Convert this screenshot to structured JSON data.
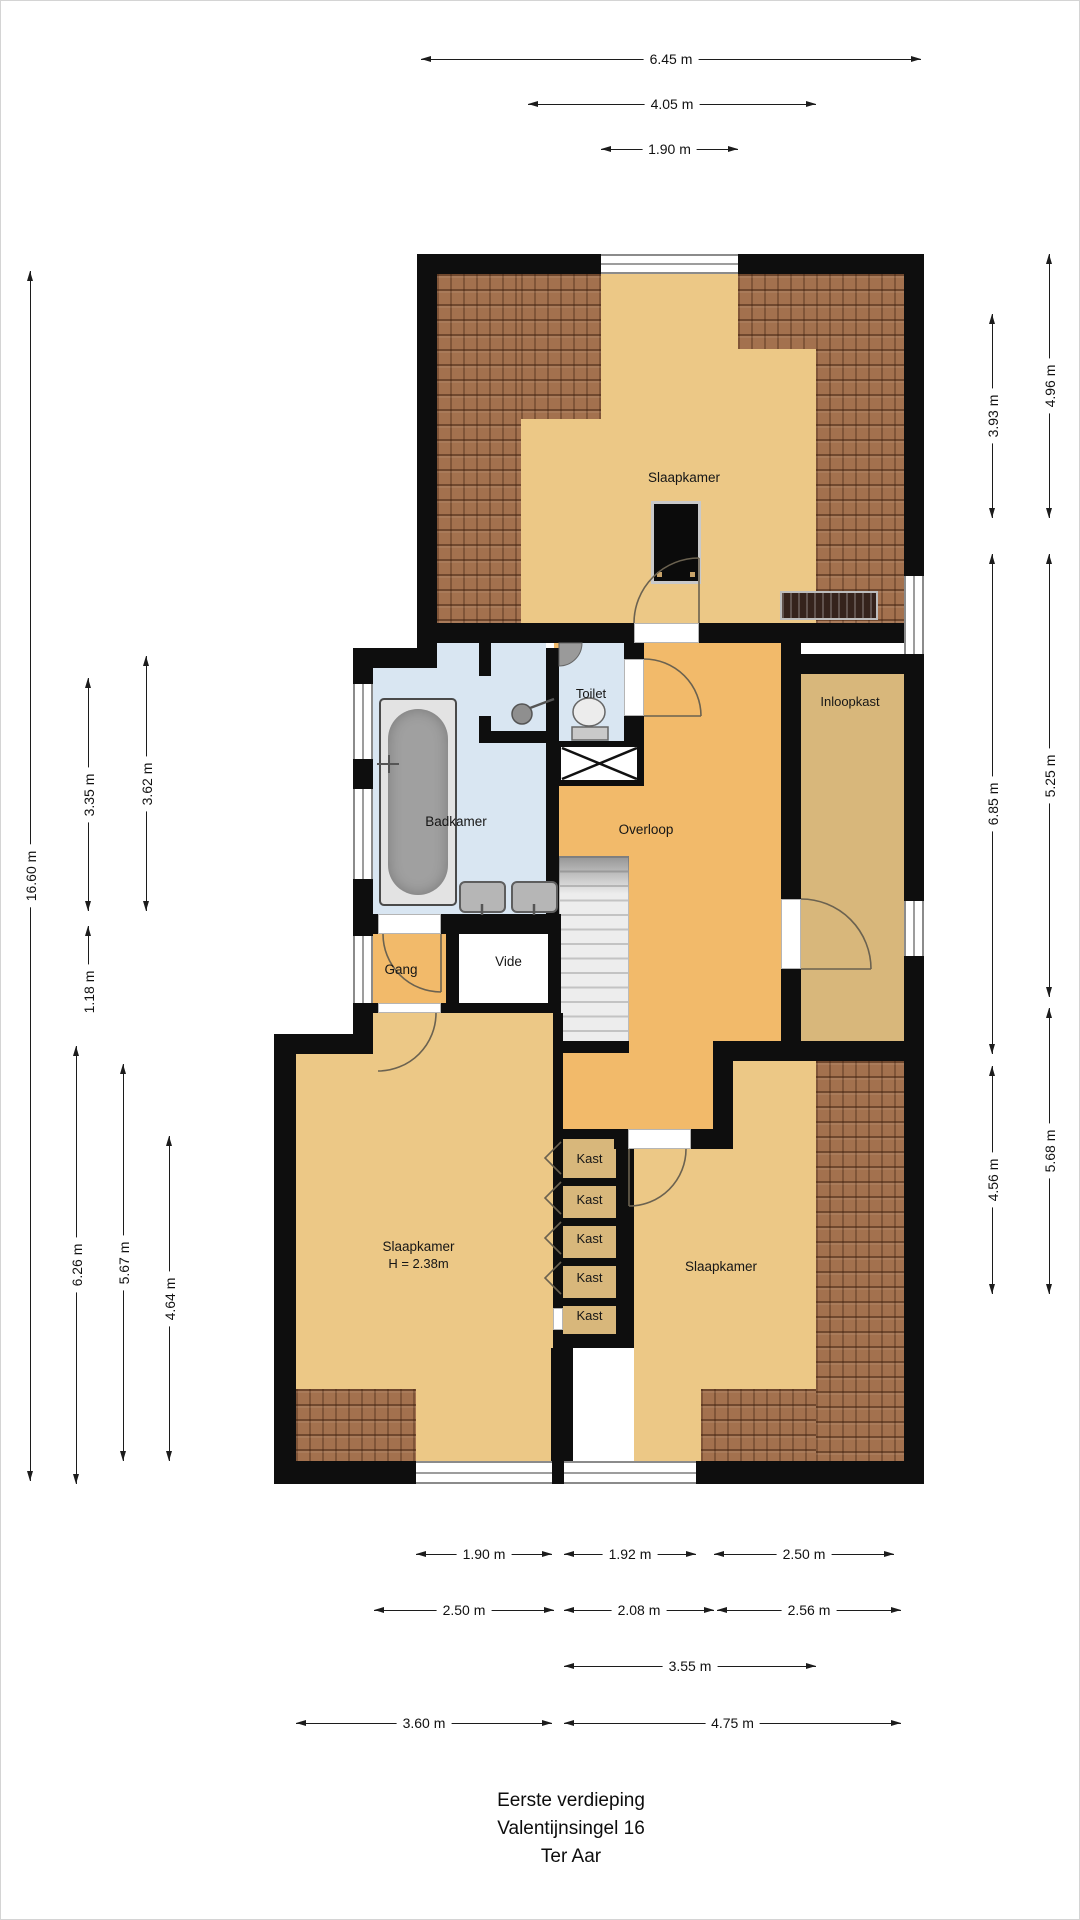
{
  "title_block": {
    "line1": "Eerste verdieping",
    "line2": "Valentijnsingel 16",
    "line3": "Ter Aar"
  },
  "rooms": {
    "slaapkamer_top": "Slaapkamer",
    "toilet": "Toilet",
    "badkamer": "Badkamer",
    "overloop": "Overloop",
    "inloopkast": "Inloopkast",
    "gang": "Gang",
    "vide": "Vide",
    "slaapkamer_left": "Slaapkamer",
    "slaapkamer_left_height": "H = 2.38m",
    "slaapkamer_right": "Slaapkamer",
    "kast": [
      "Kast",
      "Kast",
      "Kast",
      "Kast",
      "Kast"
    ]
  },
  "dimensions": {
    "top": [
      "6.45 m",
      "4.05 m",
      "1.90 m"
    ],
    "left": [
      "16.60 m",
      "3.35 m",
      "3.62 m",
      "1.18 m",
      "6.26 m",
      "5.67 m",
      "4.64 m"
    ],
    "right": [
      "4.96 m",
      "3.93 m",
      "5.25 m",
      "6.85 m",
      "5.68 m",
      "4.56 m"
    ],
    "bottom_row1": [
      "1.90 m",
      "1.92 m",
      "2.50 m"
    ],
    "bottom_row2": [
      "2.50 m",
      "2.08 m",
      "2.56 m"
    ],
    "bottom_row3": [
      "3.55 m"
    ],
    "bottom_row4": [
      "3.60 m",
      "4.75 m"
    ]
  },
  "colors": {
    "wall": "#0e0e0e",
    "bedroom_floor": "#ecc886",
    "hall_floor": "#f2ba6a",
    "closet_floor": "#d8b77b",
    "bathroom_floor": "#d9e6f2",
    "roof_tiles": "#a3714e",
    "stairs": "#ededed"
  }
}
